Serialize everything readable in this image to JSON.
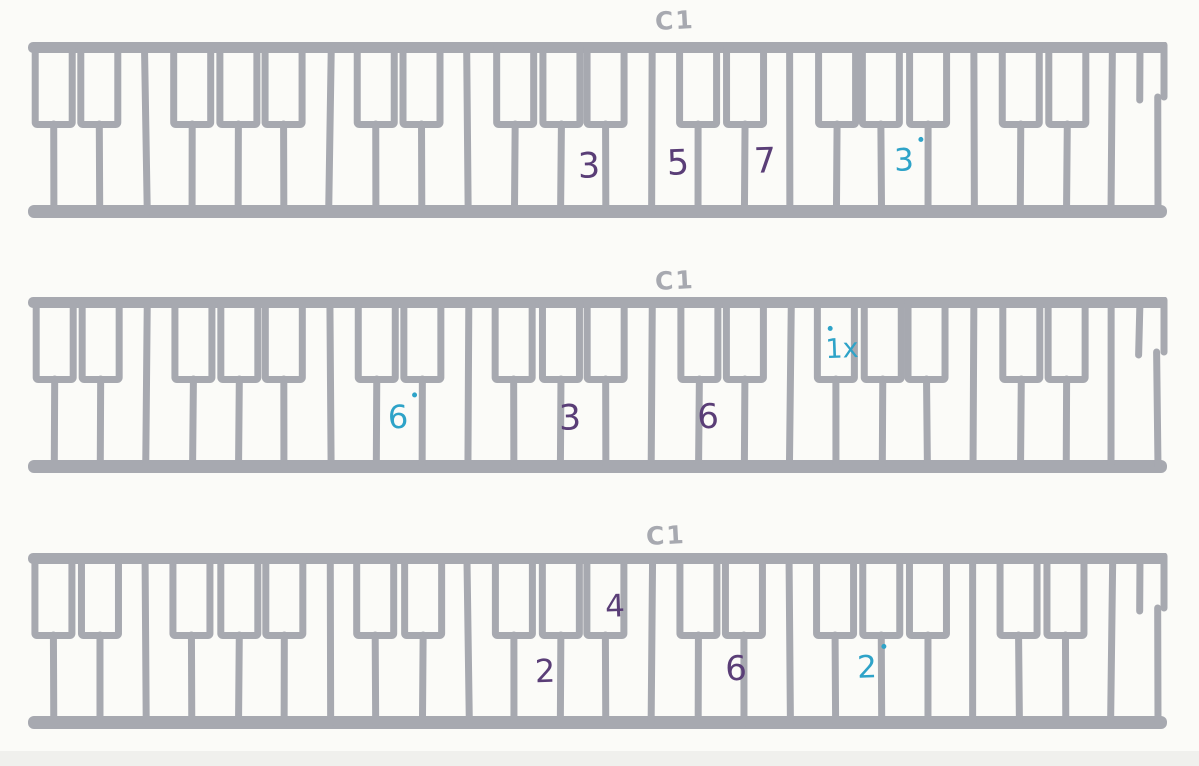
{
  "page": {
    "background": "#fbfbf8",
    "scan_edge_color": "#f0f0ed"
  },
  "ink": {
    "gray": "#a7a9b0",
    "purple": "#5a3e77",
    "teal": "#2ea3c8"
  },
  "keyboards": [
    {
      "c1_label": "C1",
      "annotations": [
        {
          "text": "3",
          "color": "purple",
          "dot": false,
          "x": 589,
          "y": 167,
          "size": 35
        },
        {
          "text": "5",
          "color": "purple",
          "dot": false,
          "x": 678,
          "y": 164,
          "size": 35
        },
        {
          "text": "7",
          "color": "purple",
          "dot": false,
          "x": 765,
          "y": 162,
          "size": 35
        },
        {
          "text": "3",
          "color": "teal",
          "dot": true,
          "x": 904,
          "y": 161,
          "size": 31
        }
      ]
    },
    {
      "c1_label": "C1",
      "annotations": [
        {
          "text": "6",
          "color": "teal",
          "dot": true,
          "x": 398,
          "y": 417,
          "size": 32
        },
        {
          "text": "3",
          "color": "purple",
          "dot": false,
          "x": 570,
          "y": 419,
          "size": 35
        },
        {
          "text": "6",
          "color": "purple",
          "dot": false,
          "x": 708,
          "y": 417,
          "size": 34
        },
        {
          "text": "1x",
          "color": "teal",
          "dot": true,
          "x": 842,
          "y": 349,
          "size": 27
        }
      ]
    },
    {
      "c1_label": "C1",
      "annotations": [
        {
          "text": "4",
          "color": "purple",
          "dot": false,
          "x": 615,
          "y": 607,
          "size": 31
        },
        {
          "text": "2",
          "color": "purple",
          "dot": false,
          "x": 545,
          "y": 671,
          "size": 32
        },
        {
          "text": "6",
          "color": "purple",
          "dot": false,
          "x": 736,
          "y": 669,
          "size": 34
        },
        {
          "text": "2",
          "color": "teal",
          "dot": true,
          "x": 867,
          "y": 668,
          "size": 31
        }
      ]
    }
  ]
}
